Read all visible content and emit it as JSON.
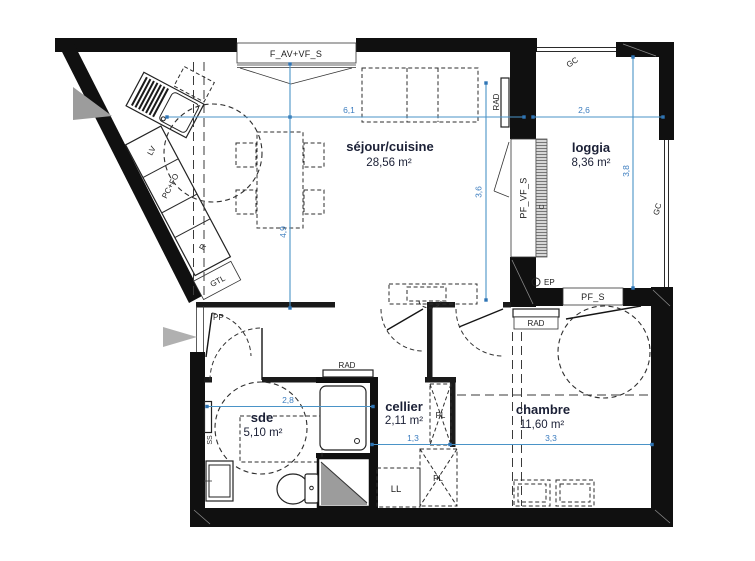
{
  "rooms": [
    {
      "name": "séjour/cuisine",
      "area": "28,56 m²"
    },
    {
      "name": "loggia",
      "area": "8,36 m²"
    },
    {
      "name": "sde",
      "area": "5,10 m²"
    },
    {
      "name": "cellier",
      "area": "2,11 m²"
    },
    {
      "name": "chambre",
      "area": "11,60 m²"
    }
  ],
  "openings": {
    "top_window": "F_AV+VF_S",
    "sejour_loggia_door_window": "PF_VF_S",
    "chambre_loggia_door_window": "PF_S",
    "entry_door": "PP",
    "guardrail": "GC",
    "shutter": "C"
  },
  "equipment": {
    "radiator": "RAD",
    "towel_radiator": "SS",
    "washing_machine": "LL",
    "dishwasher": "LV",
    "cooktop_oven": "PC+FO",
    "fridge": "R",
    "technical_duct": "GTL",
    "closet": "PL",
    "rainwater_downpipe": "EP"
  },
  "dimensions": {
    "sejour_width": "6,1",
    "sejour_depth_left": "4,9",
    "sejour_depth_right": "3,6",
    "loggia_width": "2,6",
    "loggia_depth": "3,8",
    "sde_width": "2,8",
    "cellier_width": "1,3",
    "chambre_width": "3,3"
  },
  "colors": {
    "wall": "#101010",
    "partition": "#1a1a1a",
    "dimension_line": "#4a93c7",
    "dimension_text": "#3c7dbf",
    "room_text": "#1b2036",
    "gray_shade": "#9c9c9c",
    "entry_arrow": "#b0b0b0"
  }
}
